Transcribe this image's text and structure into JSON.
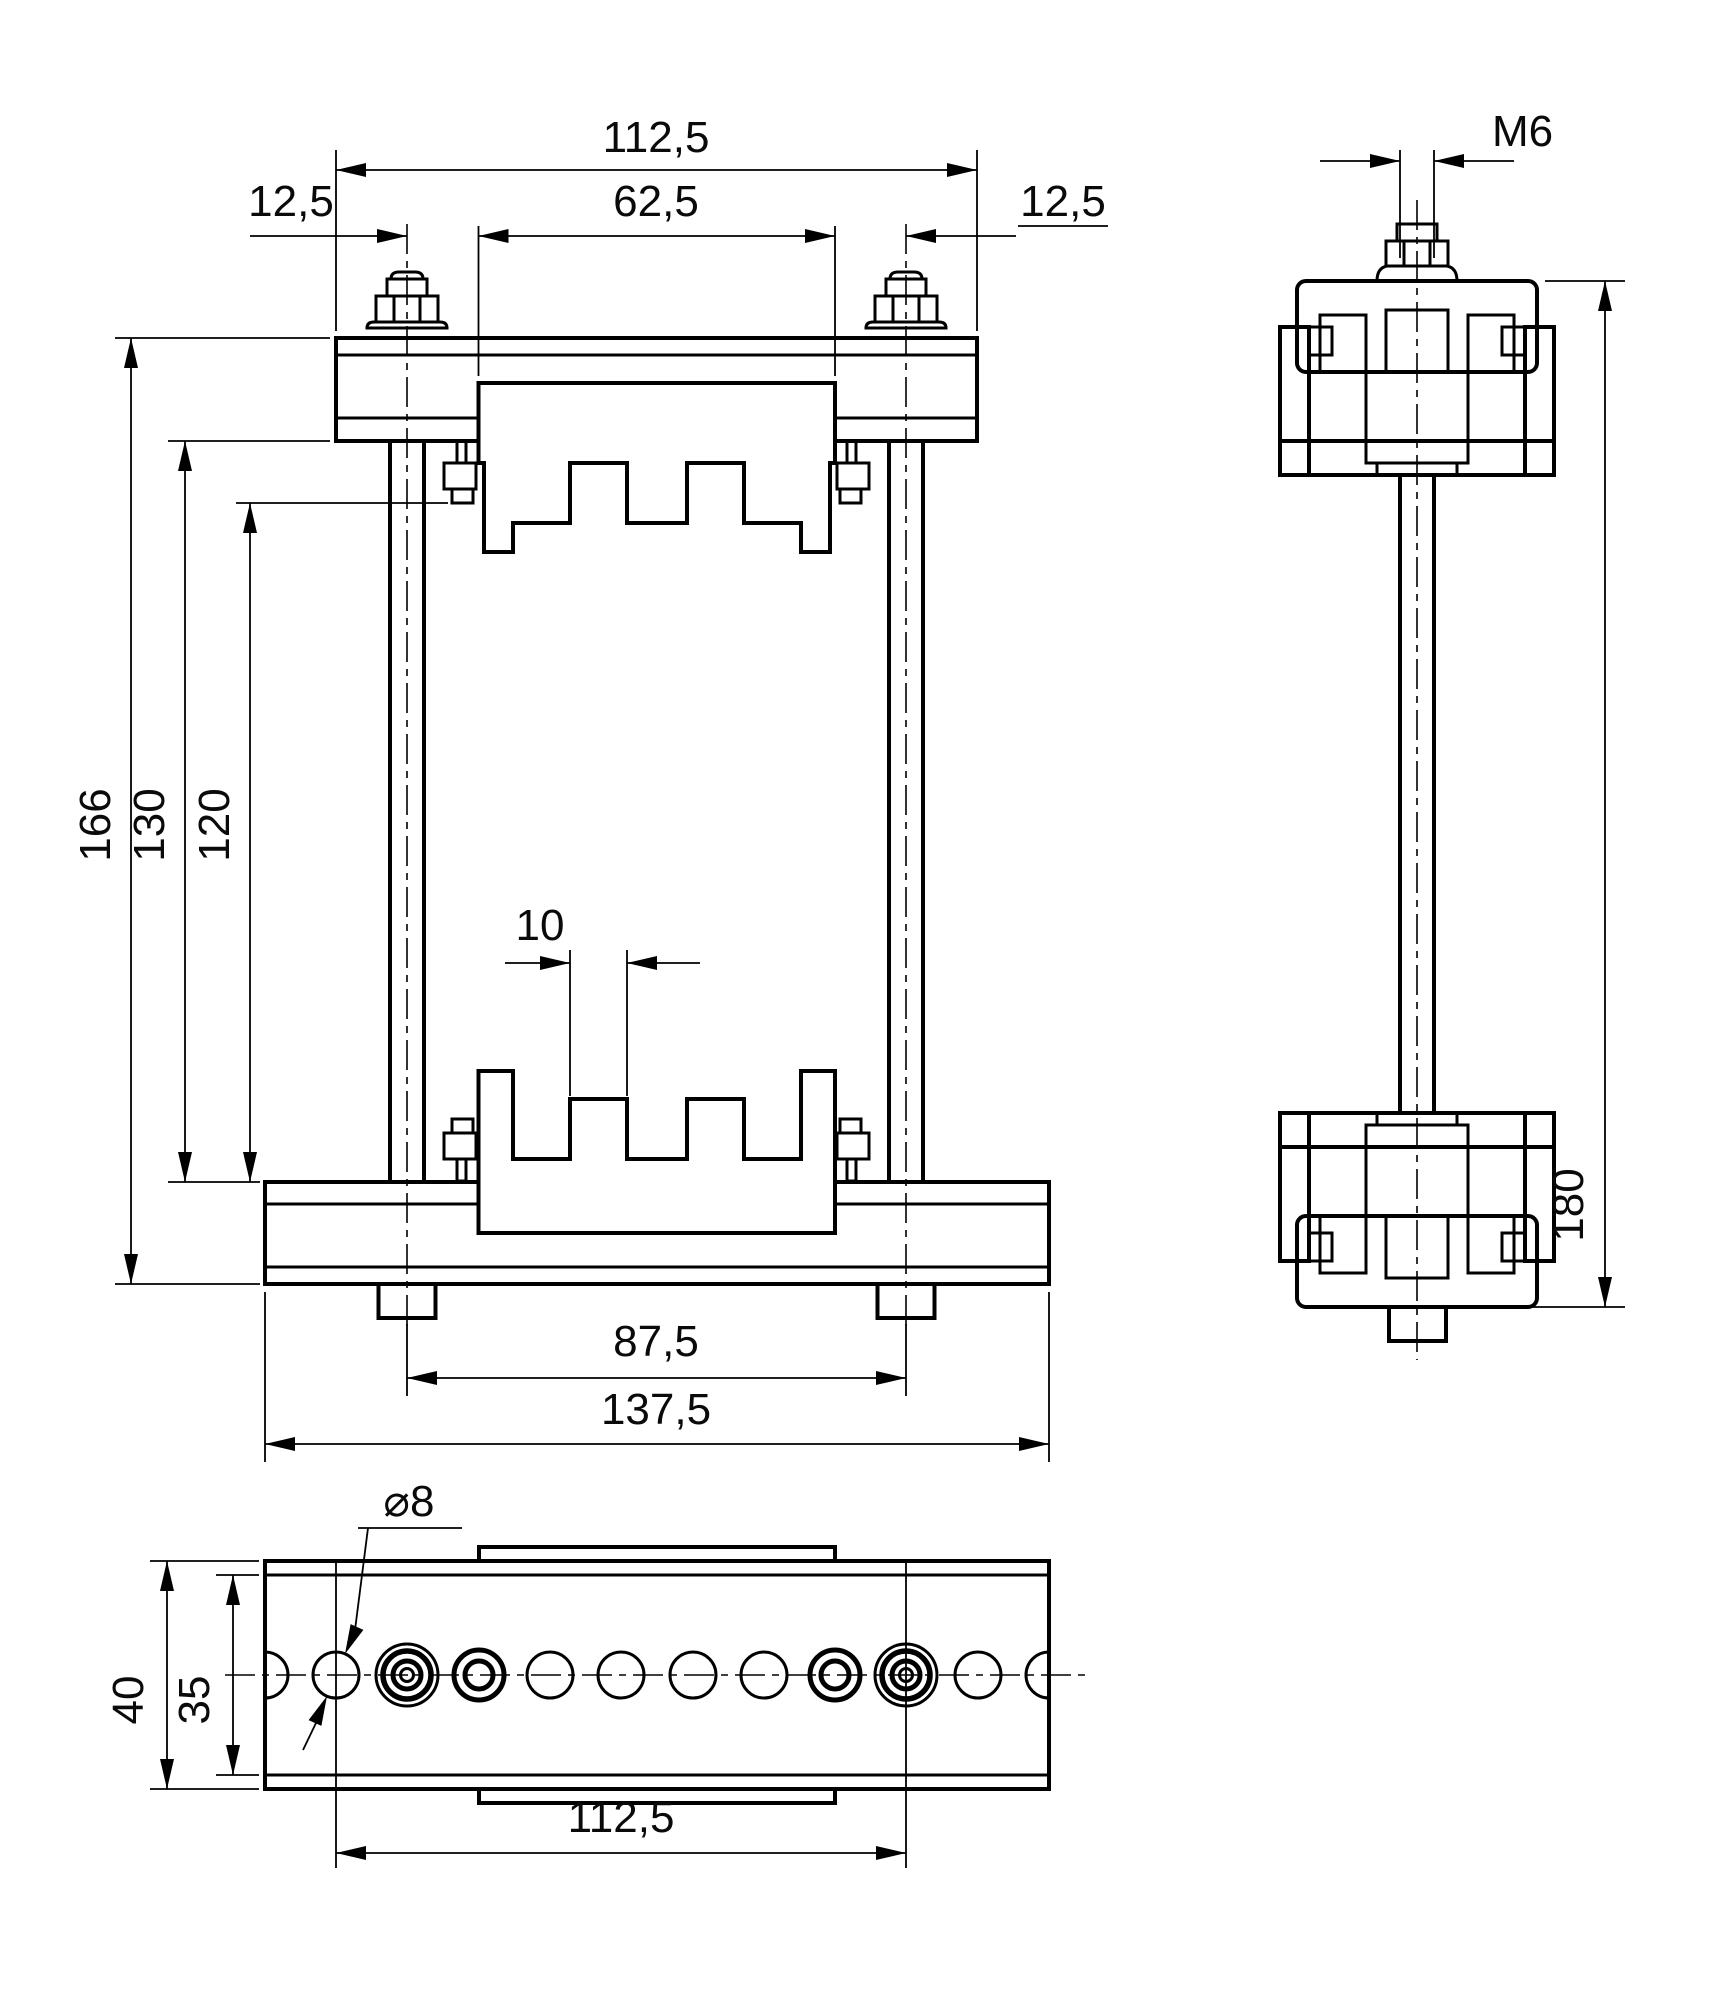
{
  "drawing": {
    "title": "clamp-fixture-orthographic-views",
    "colors": {
      "line": "#000000",
      "background": "#ffffff"
    },
    "front_view": {
      "dims": {
        "plate_width": "112,5",
        "rod_offset_left": "12,5",
        "jaw_width": "62,5",
        "rod_offset_right": "12,5",
        "overall_height": "166",
        "inner_height": "130",
        "opening_height": "120",
        "tooth_width": "10",
        "rod_spacing": "87,5",
        "base_width": "137,5"
      }
    },
    "side_view": {
      "dims": {
        "thread": "M6",
        "overall_height": "180"
      }
    },
    "bottom_view": {
      "dims": {
        "hole_diameter": "⌀8",
        "plate_depth": "40",
        "inner_depth": "35",
        "hole_row_span": "112,5"
      }
    }
  }
}
